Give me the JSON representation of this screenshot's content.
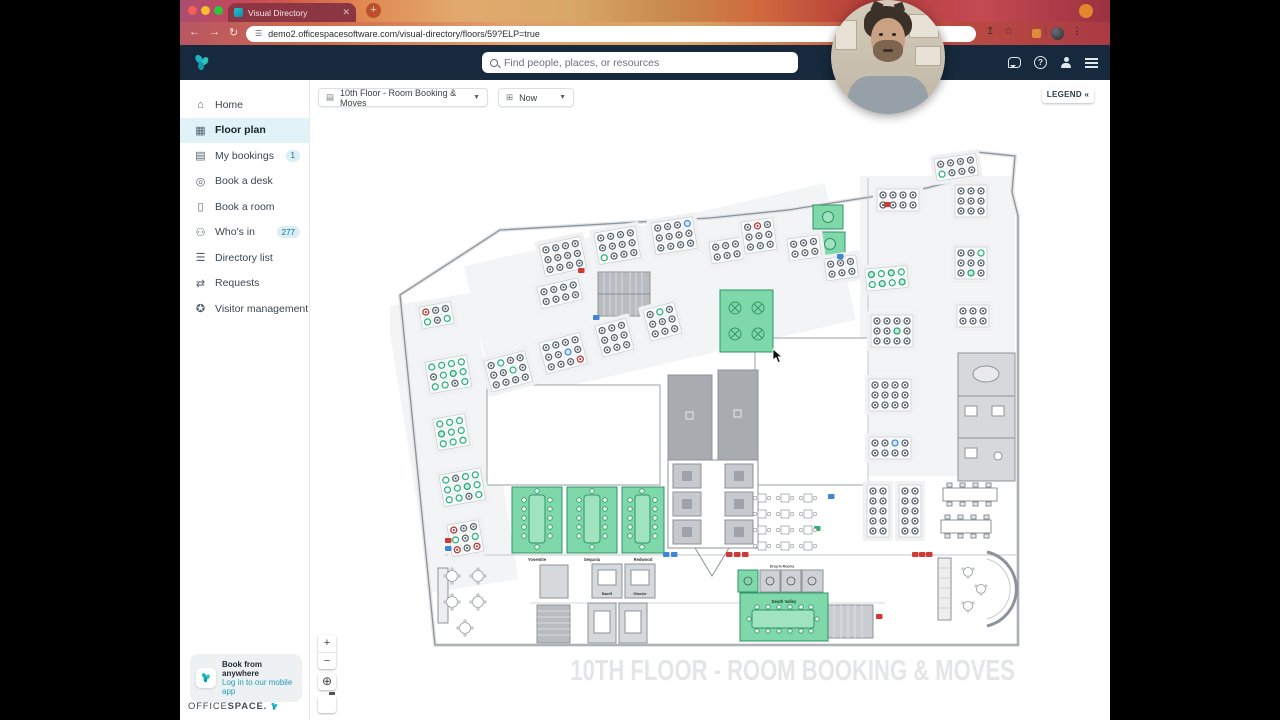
{
  "browser": {
    "tab_title": "Visual Directory",
    "url": "demo2.officespacesoftware.com/visual-directory/floors/59?ELP=true"
  },
  "navbar": {
    "search_placeholder": "Find people, places, or resources"
  },
  "sidebar": {
    "items": [
      {
        "label": "Home",
        "glyph": "⌂",
        "active": false,
        "badge": ""
      },
      {
        "label": "Floor plan",
        "glyph": "▦",
        "active": true,
        "badge": ""
      },
      {
        "label": "My bookings",
        "glyph": "▤",
        "active": false,
        "badge": "1"
      },
      {
        "label": "Book a desk",
        "glyph": "◎",
        "active": false,
        "badge": ""
      },
      {
        "label": "Book a room",
        "glyph": "▯",
        "active": false,
        "badge": ""
      },
      {
        "label": "Who's in",
        "glyph": "⚇",
        "active": false,
        "badge": "277"
      },
      {
        "label": "Directory list",
        "glyph": "☰",
        "active": false,
        "badge": ""
      },
      {
        "label": "Requests",
        "glyph": "⇄",
        "active": false,
        "badge": ""
      },
      {
        "label": "Visitor management",
        "glyph": "✪",
        "active": false,
        "badge": ""
      }
    ],
    "promo": {
      "title": "Book from anywhere",
      "subtitle": "Log in to our mobile app"
    },
    "logo": {
      "part1": "OFFICE",
      "part2": "SPACE."
    }
  },
  "toolbar": {
    "floor_selector": "10th Floor - Room Booking & Moves",
    "time_selector": "Now",
    "legend_label": "LEGEND «"
  },
  "map_controls": {
    "zoom_in": "+",
    "zoom_out": "−",
    "globe": "⊕"
  },
  "floorplan": {
    "watermark": "10TH FLOOR - ROOM BOOKING & MOVES",
    "room_labels": {
      "yosemite": "Yosemite",
      "sequoia": "Sequoia",
      "redwood": "Redwood",
      "death_valley": "Death Valley",
      "banff": "Banff",
      "glacier": "Glacier",
      "drop_in": "Drop-In Rooms"
    },
    "colors": {
      "available": "#2eb57e",
      "occupied": "#5c666f",
      "alert": "#b23b3b",
      "info": "#4a90d9",
      "room_fill": "#7fd8aa",
      "room_border": "#2f9465",
      "core": "#a8acb1"
    },
    "clusters": [
      [
        30,
        160,
        2,
        3,
        -10,
        "rddgdg"
      ],
      [
        36,
        215,
        3,
        4,
        -10,
        "ggggdgtgggdg"
      ],
      [
        44,
        272,
        3,
        3,
        -10,
        "gggtggggg"
      ],
      [
        50,
        328,
        3,
        4,
        -10,
        "gdggggtgggdg"
      ],
      [
        58,
        378,
        3,
        3,
        -10,
        "rddgdgrdr"
      ],
      [
        95,
        214,
        3,
        4,
        -15,
        "dgddddgddddd"
      ],
      [
        150,
        196,
        3,
        4,
        -15,
        "ddddddbddddr"
      ],
      [
        206,
        179,
        3,
        3,
        -15,
        "ddddddddd"
      ],
      [
        254,
        163,
        3,
        3,
        -15,
        "dgddddddd"
      ],
      [
        148,
        140,
        2,
        4,
        -13,
        "dddddddd"
      ],
      [
        150,
        98,
        3,
        4,
        -12,
        "dddddddddddd"
      ],
      [
        205,
        86,
        3,
        4,
        -10,
        "ddddddddgddd"
      ],
      [
        262,
        76,
        3,
        4,
        -9,
        "dddbdddddddd"
      ],
      [
        320,
        95,
        2,
        3,
        -9,
        "dddddd"
      ],
      [
        352,
        75,
        3,
        3,
        -8,
        "drddddddd"
      ],
      [
        398,
        92,
        2,
        3,
        -8,
        "dddddd"
      ],
      [
        435,
        112,
        2,
        3,
        -8,
        "dddddd"
      ],
      [
        545,
        12,
        2,
        4,
        -8,
        "ddddgddd"
      ],
      [
        488,
        42,
        2,
        4,
        0,
        "dddddddd"
      ],
      [
        476,
        122,
        2,
        4,
        -5,
        "tgtggtgt"
      ],
      [
        482,
        168,
        3,
        4,
        0,
        "ddddddtddddd"
      ],
      [
        480,
        232,
        3,
        4,
        0,
        "dddddddddddd"
      ],
      [
        480,
        290,
        2,
        4,
        0,
        "ddbddddd"
      ],
      [
        566,
        38,
        3,
        3,
        0,
        "ddddddddd"
      ],
      [
        566,
        100,
        3,
        3,
        0,
        "ddgddddtd"
      ],
      [
        568,
        158,
        2,
        3,
        0,
        "dddddd"
      ],
      [
        478,
        338,
        5,
        2,
        0,
        "dddddddddd"
      ],
      [
        510,
        338,
        5,
        2,
        0,
        "dddddddddd"
      ]
    ],
    "markers": [
      [
        188,
        120,
        "r"
      ],
      [
        494,
        54,
        "r"
      ],
      [
        336,
        404,
        "r"
      ],
      [
        344,
        404,
        "r"
      ],
      [
        352,
        404,
        "r"
      ],
      [
        522,
        404,
        "r"
      ],
      [
        529,
        404,
        "r"
      ],
      [
        536,
        404,
        "r"
      ],
      [
        273,
        404,
        "b"
      ],
      [
        281,
        404,
        "b"
      ],
      [
        438,
        346,
        "b"
      ],
      [
        447,
        106,
        "b"
      ],
      [
        203,
        167,
        "b"
      ],
      [
        55,
        390,
        "r"
      ],
      [
        55,
        398,
        "b"
      ],
      [
        486,
        466,
        "r"
      ],
      [
        424,
        378,
        "g"
      ]
    ],
    "round_tables": [
      [
        62,
        428
      ],
      [
        88,
        428
      ],
      [
        62,
        454
      ],
      [
        88,
        454
      ],
      [
        75,
        480
      ]
    ],
    "lounge_tables": [
      [
        578,
        424
      ],
      [
        591,
        441
      ],
      [
        578,
        458
      ]
    ],
    "mini_tables": [
      [
        368,
        346
      ],
      [
        391,
        346
      ],
      [
        414,
        346
      ],
      [
        368,
        362
      ],
      [
        391,
        362
      ],
      [
        414,
        362
      ],
      [
        368,
        378
      ],
      [
        391,
        378
      ],
      [
        414,
        378
      ],
      [
        368,
        394
      ],
      [
        391,
        394
      ],
      [
        414,
        394
      ]
    ]
  }
}
